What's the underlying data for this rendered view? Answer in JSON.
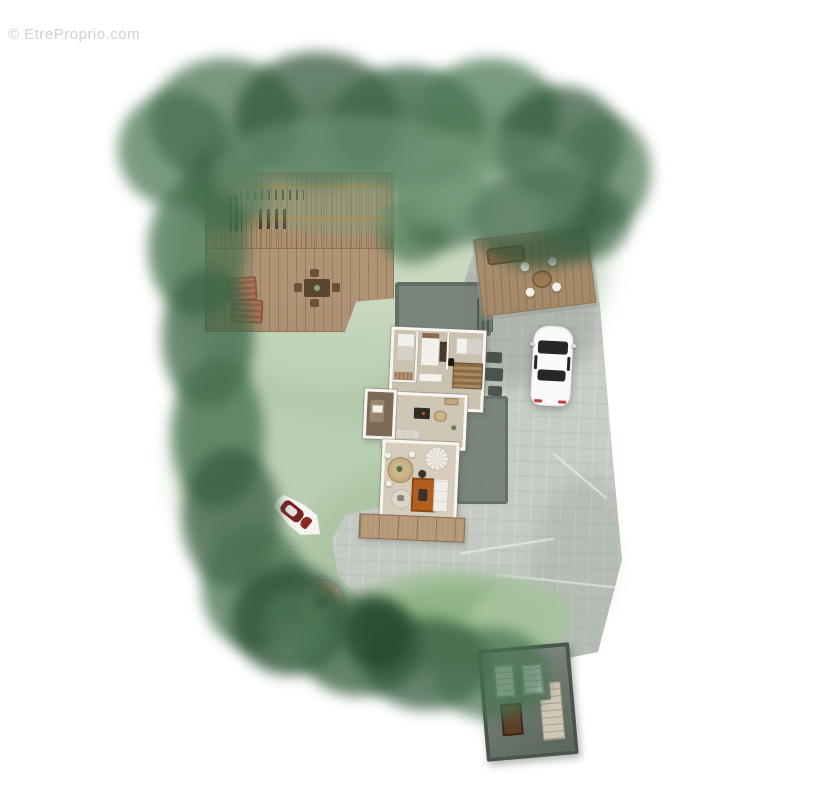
{
  "watermark": {
    "text": "© EtreProprio.com"
  },
  "palette": {
    "background": "#ffffff",
    "lawn_green": "#b9cdb0",
    "hedge_green_dark": "#35593d",
    "hedge_green": "#47714f",
    "deck_wood": "#b59878",
    "pergola_beam_orange": "#c8823e",
    "patio_wood": "#ab9072",
    "pavement_gray": "#c6cbc4",
    "pavement_dark": "#75817a",
    "house_wall_white": "#f8f6f2",
    "house_floor_beige": "#cfc6b5",
    "terrace_wood": "#b49878",
    "rug_orange": "#b05f1e",
    "car_body_white": "#fafafa",
    "car_glass_dark": "#262626",
    "boat_hull_white": "#f5f4f1",
    "boat_cockpit_red": "#772420",
    "well_gravel_tan": "#c9b191",
    "well_center_brown": "#5d3f2a",
    "shed_roof_gray_green": "#6a756c"
  }
}
